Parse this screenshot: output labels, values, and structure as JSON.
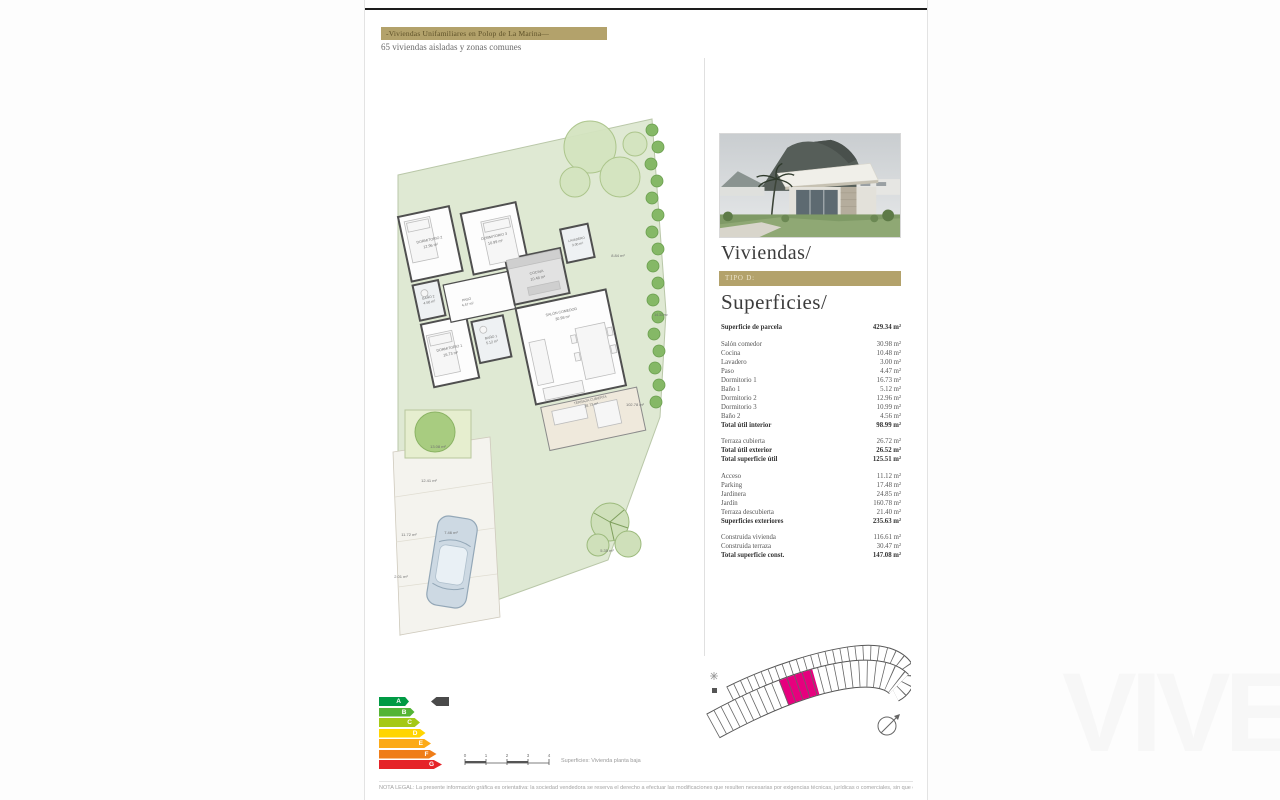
{
  "header": {
    "banner": "-Viviendas Unifamiliares en Polop de La Marina—",
    "subtitle": "65 viviendas aisladas y zonas comunes"
  },
  "panel": {
    "title": "Viviendas/",
    "tipo": "TIPO D:",
    "section": "Superficies/",
    "groups": [
      {
        "rows": [
          {
            "label": "Superficie de parcela",
            "value": "429.34 m²",
            "bold": true
          }
        ]
      },
      {
        "rows": [
          {
            "label": "Salón comedor",
            "value": "30.98 m²"
          },
          {
            "label": "Cocina",
            "value": "10.48 m²"
          },
          {
            "label": "Lavadero",
            "value": "3.00 m²"
          },
          {
            "label": "Paso",
            "value": "4.47 m²"
          },
          {
            "label": "Dormitorio 1",
            "value": "16.73 m²"
          },
          {
            "label": "Baño 1",
            "value": "5.12 m²"
          },
          {
            "label": "Dormitorio 2",
            "value": "12.96 m²"
          },
          {
            "label": "Dormitorio 3",
            "value": "10.99 m²"
          },
          {
            "label": "Baño 2",
            "value": "4.56 m²"
          },
          {
            "label": "Total útil interior",
            "value": "98.99 m²",
            "bold": true
          }
        ]
      },
      {
        "rows": [
          {
            "label": "Terraza cubierta",
            "value": "26.72 m²"
          },
          {
            "label": "Total útil exterior",
            "value": "26.52 m²",
            "bold": true
          },
          {
            "label": "Total superficie útil",
            "value": "125.51 m²",
            "bold": true
          }
        ]
      },
      {
        "rows": [
          {
            "label": "Acceso",
            "value": "11.12 m²"
          },
          {
            "label": "Parking",
            "value": "17.48 m²"
          },
          {
            "label": "Jardinera",
            "value": "24.85 m²"
          },
          {
            "label": "Jardín",
            "value": "160.78 m²"
          },
          {
            "label": "Terraza descubierta",
            "value": "21.40 m²"
          },
          {
            "label": "Superficies exteriores",
            "value": "235.63 m²",
            "bold": true
          }
        ]
      },
      {
        "rows": [
          {
            "label": "Construida vivienda",
            "value": "116.61 m²"
          },
          {
            "label": "Construida terraza",
            "value": "30.47 m²"
          },
          {
            "label": "Total superficie const.",
            "value": "147.08 m²",
            "bold": true
          }
        ]
      }
    ]
  },
  "plan": {
    "rooms": [
      {
        "name": "DORMITORIO 2",
        "area": "12.96 m²"
      },
      {
        "name": "DORMITORIO 3",
        "area": "10.99 m²"
      },
      {
        "name": "BAÑO 2",
        "area": "4.56 m²"
      },
      {
        "name": "DORMITORIO 1",
        "area": "16.73 m²"
      },
      {
        "name": "BAÑO 1",
        "area": "5.12 m²"
      },
      {
        "name": "PASO",
        "area": "4.47 m²"
      },
      {
        "name": "COCINA",
        "area": "10.48 m²"
      },
      {
        "name": "LAVADERO",
        "area": "3.00 m²"
      },
      {
        "name": "SALÓN COMEDOR",
        "area": "30.98 m²"
      },
      {
        "name": "TERRAZA CUBIERTA",
        "area": "28.73 m²"
      }
    ],
    "outdoor": [
      {
        "text": "8.84 m²"
      },
      {
        "text": "102.78 m²"
      },
      {
        "text": "14.33 m²"
      },
      {
        "text": "13.08 m²"
      },
      {
        "text": "12.41 m²"
      },
      {
        "text": "11.72 m²"
      },
      {
        "text": "7.46 m²"
      },
      {
        "text": "5.35 m²"
      },
      {
        "text": "2.01 m²"
      }
    ],
    "scale": {
      "ticks": [
        "0",
        "1",
        "2",
        "3",
        "4"
      ],
      "caption": "Superficies: Vivienda planta baja"
    }
  },
  "energy": {
    "ratings": [
      {
        "letter": "A",
        "color": "#009a44"
      },
      {
        "letter": "B",
        "color": "#54b435"
      },
      {
        "letter": "C",
        "color": "#a5c916"
      },
      {
        "letter": "D",
        "color": "#ffd500"
      },
      {
        "letter": "E",
        "color": "#fcaa17"
      },
      {
        "letter": "F",
        "color": "#ef7d18"
      },
      {
        "letter": "G",
        "color": "#e52328"
      }
    ]
  },
  "siteplan": {
    "highlight": "#e6007e"
  },
  "footer": {
    "disclaimer": "NOTA LEGAL: La presente información gráfica es orientativa: la sociedad vendedora se reserva el derecho a efectuar las modificaciones que resulten necesarias por exigencias técnicas, jurídicas o comerciales, sin que ello suponga merma de calidades y acabados."
  },
  "watermark": {
    "text": "VIVE"
  },
  "colors": {
    "gold": "#b3a26b",
    "highlight": "#e6007e",
    "garden": "#dfe9d3"
  }
}
